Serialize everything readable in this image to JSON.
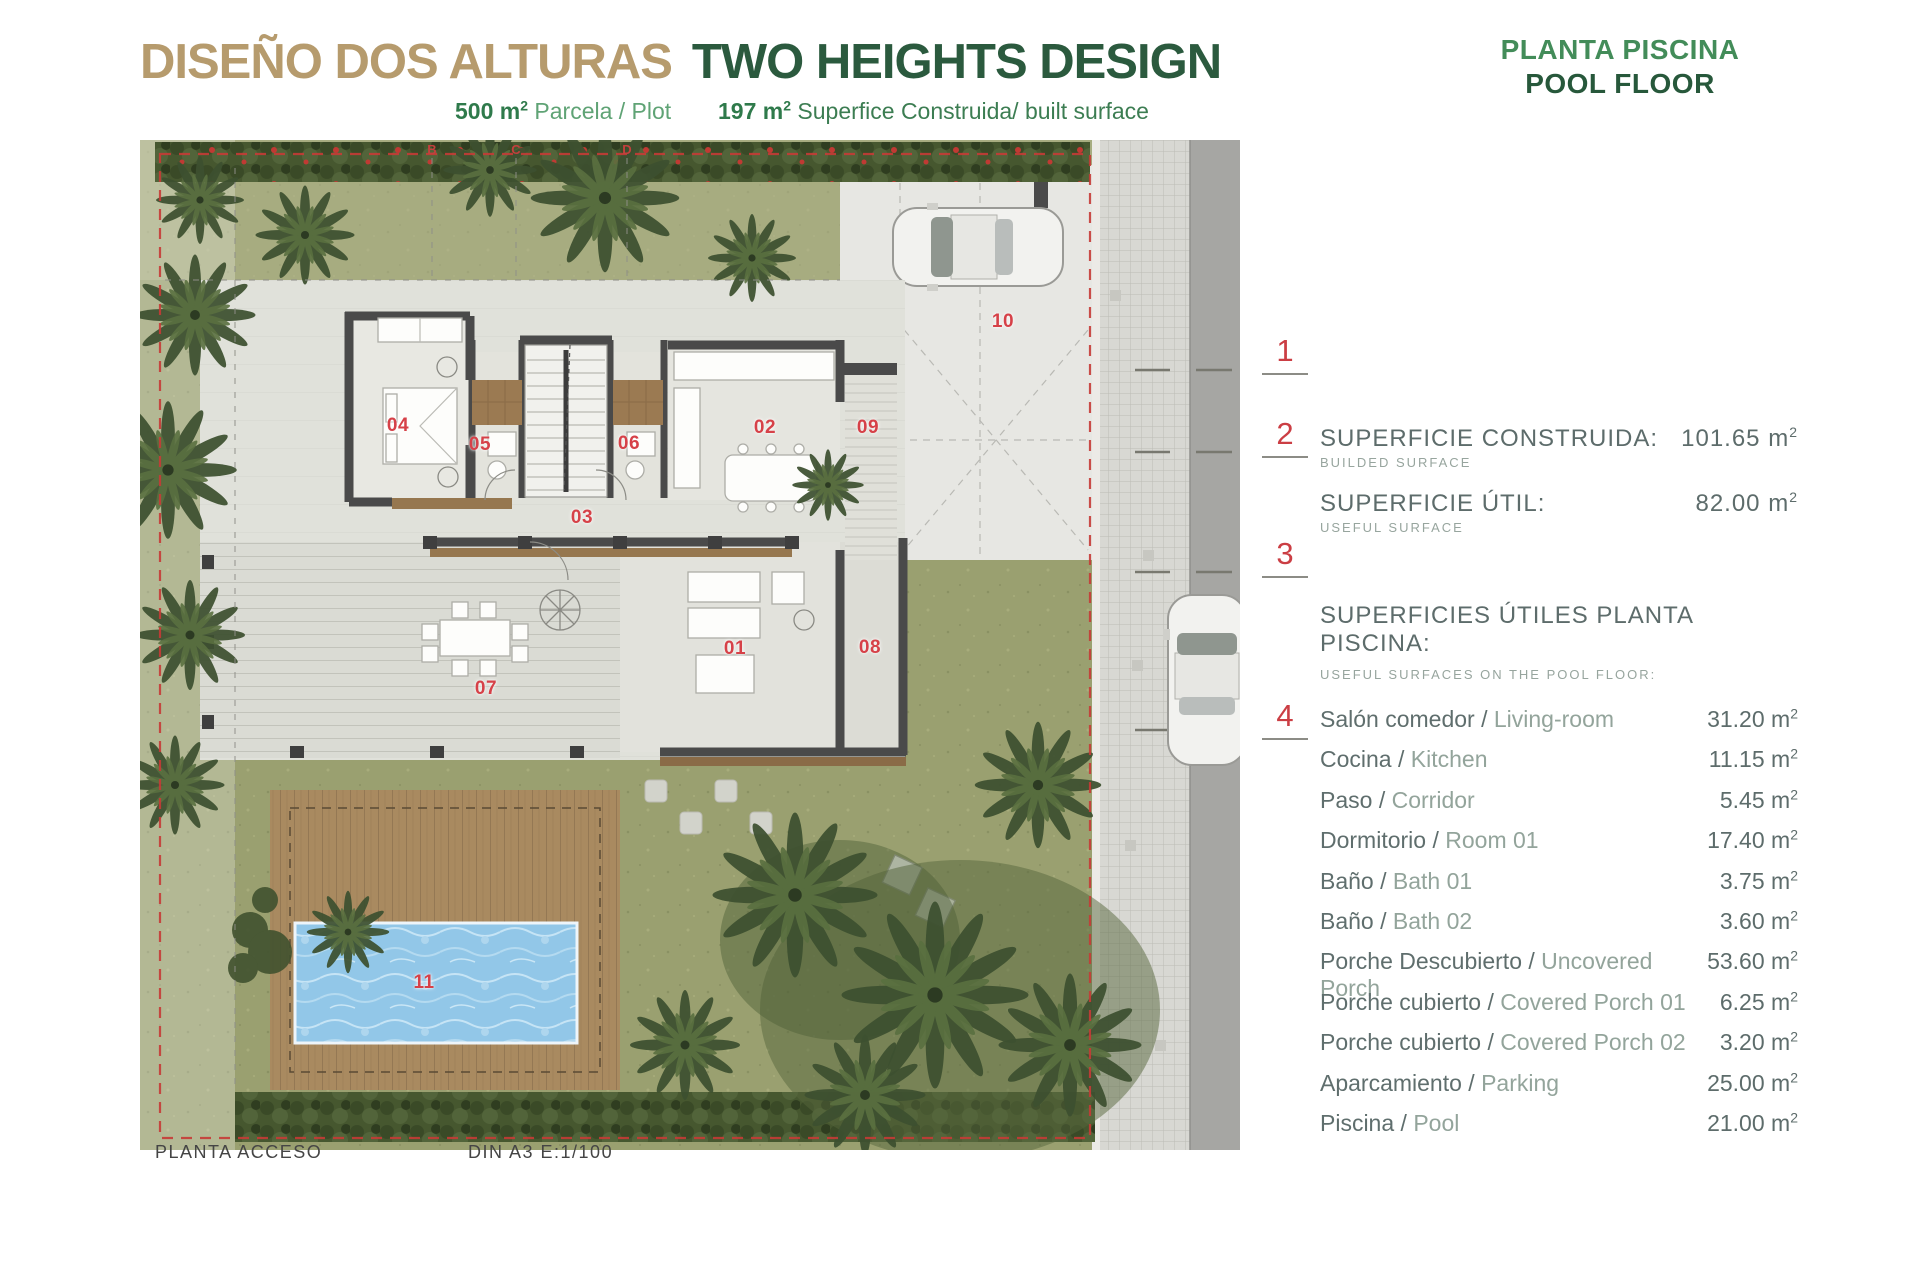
{
  "header": {
    "title_es": "DISEÑO DOS ALTURAS",
    "title_en": "TWO HEIGHTS DESIGN",
    "plot_value": "500 m",
    "plot_sup": "2",
    "plot_label": "Parcela / Plot",
    "built_value": "197 m",
    "built_sup": "2",
    "built_label": "Superfice Construida/ built surface",
    "floor_es": "PLANTA PISCINA",
    "floor_en": "POOL FLOOR"
  },
  "plan": {
    "room_labels": [
      {
        "id": "01",
        "x": 595,
        "y": 509
      },
      {
        "id": "02",
        "x": 625,
        "y": 288
      },
      {
        "id": "03",
        "x": 442,
        "y": 378
      },
      {
        "id": "04",
        "x": 258,
        "y": 286
      },
      {
        "id": "05",
        "x": 340,
        "y": 305
      },
      {
        "id": "06",
        "x": 489,
        "y": 304
      },
      {
        "id": "07",
        "x": 346,
        "y": 549
      },
      {
        "id": "08",
        "x": 730,
        "y": 508
      },
      {
        "id": "09",
        "x": 728,
        "y": 288
      },
      {
        "id": "10",
        "x": 863,
        "y": 182
      },
      {
        "id": "11",
        "x": 284,
        "y": 843
      }
    ],
    "grid_letters": [
      {
        "id": "B",
        "x": 292
      },
      {
        "id": "C",
        "x": 376
      },
      {
        "id": "D",
        "x": 487
      }
    ],
    "markers": [
      {
        "id": "1",
        "y": 335
      },
      {
        "id": "2",
        "y": 418
      },
      {
        "id": "3",
        "y": 538
      },
      {
        "id": "4",
        "y": 700
      }
    ],
    "footer_left": "PLANTA ACCESO",
    "footer_scale": "DIN A3  E:1/100"
  },
  "summary": {
    "totals": [
      {
        "label": "SUPERFICIE CONSTRUIDA:",
        "sublabel": "BUILDED SURFACE",
        "value": "101.65"
      },
      {
        "label": "SUPERFICIE ÚTIL:",
        "sublabel": "USEFUL SURFACE",
        "value": "82.00"
      }
    ],
    "section_title": "SUPERFICIES ÚTILES PLANTA PISCINA:",
    "section_subtitle": "USEFUL SURFACES ON THE POOL FLOOR:",
    "items": [
      {
        "es": "Salón comedor /",
        "en": "Living-room",
        "value": "31.20"
      },
      {
        "es": "Cocina /",
        "en": "Kitchen",
        "value": "11.15"
      },
      {
        "es": "Paso /",
        "en": "Corridor",
        "value": "5.45"
      },
      {
        "es": "Dormitorio /",
        "en": "Room 01",
        "value": "17.40"
      },
      {
        "es": "Baño /",
        "en": "Bath 01",
        "value": "3.75"
      },
      {
        "es": "Baño /",
        "en": "Bath 02",
        "value": "3.60"
      },
      {
        "es": "Porche Descubierto /",
        "en": "Uncovered Porch",
        "value": "53.60"
      },
      {
        "es": "Porche cubierto /",
        "en": "Covered Porch 01",
        "value": "6.25"
      },
      {
        "es": "Porche cubierto /",
        "en": "Covered Porch 02",
        "value": "3.20"
      },
      {
        "es": "Aparcamiento /",
        "en": "Parking",
        "value": "25.00"
      },
      {
        "es": "Piscina /",
        "en": "Pool",
        "value": "21.00"
      }
    ],
    "unit_base": " m",
    "unit_sup": "2"
  },
  "colors": {
    "accent_red": "#cb3e44",
    "title_tan": "#b69b6d",
    "title_green": "#2b5a3e",
    "panel_text": "#5d6c6b"
  }
}
